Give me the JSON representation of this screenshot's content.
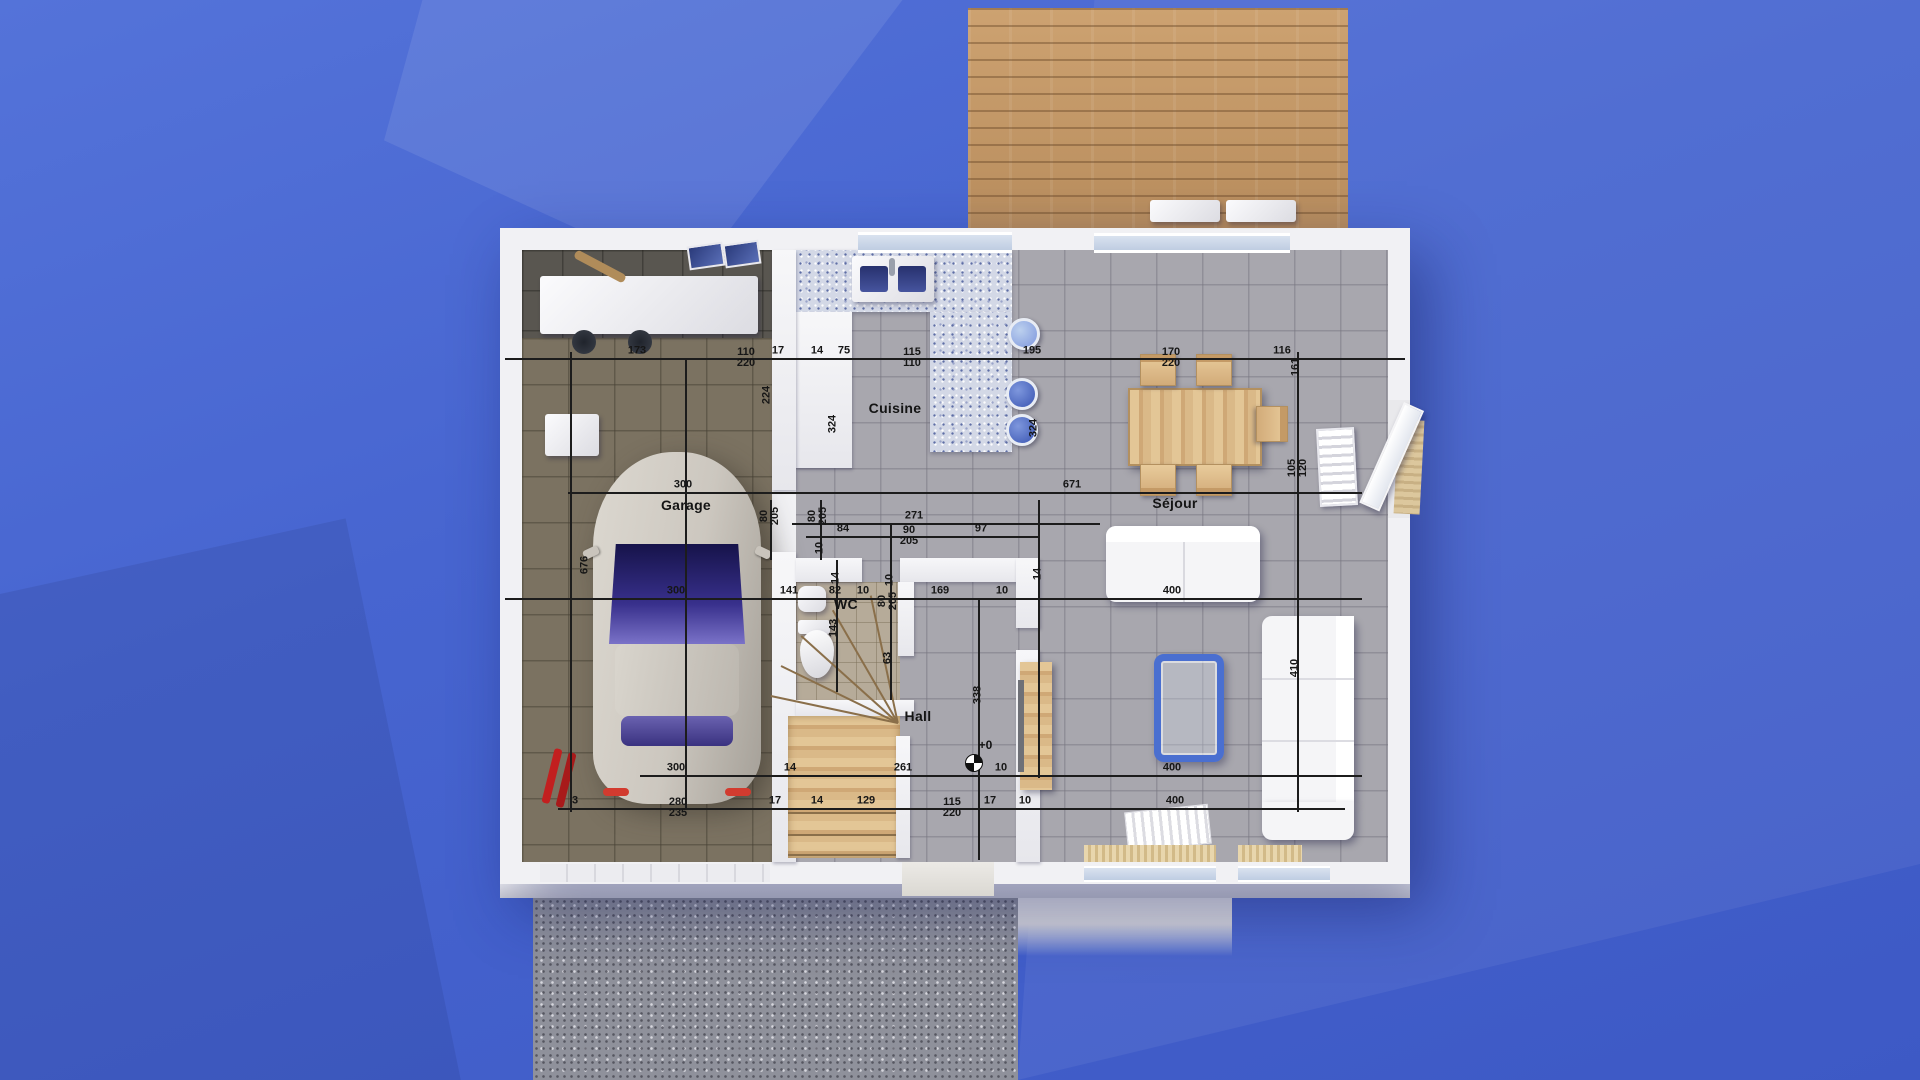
{
  "scene": {
    "description": "3D rendered ground-floor plan of a house on blue faceted background",
    "colors": {
      "background_blue": "#4765d0",
      "deck_wood": "#c59a6b",
      "gravel": "#8f919b",
      "wall_white": "#f1f1f4",
      "tile_floor": "#a8a7ae",
      "garage_floor": "#7b7261",
      "wc_floor": "#b6ab99",
      "counter_terrazzo": "#d3d8e6",
      "coffee_table_blue": "#4a6fd0",
      "dim_line": "#1c1c1c",
      "car_body": "#ccc7bf",
      "windshield": "#38308c"
    }
  },
  "rooms": [
    {
      "id": "garage",
      "label": "Garage",
      "x": 686,
      "y": 505
    },
    {
      "id": "cuisine",
      "label": "Cuisine",
      "x": 895,
      "y": 408
    },
    {
      "id": "wc",
      "label": "WC",
      "x": 846,
      "y": 604
    },
    {
      "id": "hall",
      "label": "Hall",
      "x": 918,
      "y": 716
    },
    {
      "id": "sejour",
      "label": "Séjour",
      "x": 1175,
      "y": 503
    }
  ],
  "level_marker": {
    "label": "+0",
    "x": 974,
    "y": 763
  },
  "dimensions": {
    "labels_horizontal": [
      {
        "x": 637,
        "y": 358,
        "t": "173"
      },
      {
        "x": 746,
        "y": 358,
        "t": "110",
        "b": "220"
      },
      {
        "x": 778,
        "y": 358,
        "t": "17"
      },
      {
        "x": 817,
        "y": 358,
        "t": "14"
      },
      {
        "x": 844,
        "y": 358,
        "t": "75"
      },
      {
        "x": 912,
        "y": 358,
        "t": "115",
        "b": "110"
      },
      {
        "x": 1032,
        "y": 358,
        "t": "195"
      },
      {
        "x": 1171,
        "y": 358,
        "t": "170",
        "b": "220"
      },
      {
        "x": 1282,
        "y": 358,
        "t": "116"
      },
      {
        "x": 683,
        "y": 492,
        "t": "300"
      },
      {
        "x": 1072,
        "y": 492,
        "t": "671"
      },
      {
        "x": 914,
        "y": 523,
        "t": "271"
      },
      {
        "x": 843,
        "y": 536,
        "t": "84"
      },
      {
        "x": 909,
        "y": 536,
        "t": "90",
        "b": "205"
      },
      {
        "x": 981,
        "y": 536,
        "t": "97"
      },
      {
        "x": 676,
        "y": 598,
        "t": "300"
      },
      {
        "x": 789,
        "y": 598,
        "t": "141"
      },
      {
        "x": 835,
        "y": 598,
        "t": "82"
      },
      {
        "x": 863,
        "y": 598,
        "t": "10"
      },
      {
        "x": 940,
        "y": 598,
        "t": "169"
      },
      {
        "x": 1002,
        "y": 598,
        "t": "10"
      },
      {
        "x": 1172,
        "y": 598,
        "t": "400"
      },
      {
        "x": 676,
        "y": 775,
        "t": "300"
      },
      {
        "x": 790,
        "y": 775,
        "t": "14"
      },
      {
        "x": 903,
        "y": 775,
        "t": "261"
      },
      {
        "x": 1001,
        "y": 775,
        "t": "10"
      },
      {
        "x": 1172,
        "y": 775,
        "t": "400"
      },
      {
        "x": 575,
        "y": 808,
        "t": "3"
      },
      {
        "x": 678,
        "y": 808,
        "t": "280",
        "b": "235"
      },
      {
        "x": 775,
        "y": 808,
        "t": "17"
      },
      {
        "x": 817,
        "y": 808,
        "t": "14"
      },
      {
        "x": 866,
        "y": 808,
        "t": "129"
      },
      {
        "x": 952,
        "y": 808,
        "t": "115",
        "b": "220"
      },
      {
        "x": 990,
        "y": 808,
        "t": "17"
      },
      {
        "x": 1025,
        "y": 808,
        "t": "10"
      },
      {
        "x": 1175,
        "y": 808,
        "t": "400"
      }
    ],
    "labels_vertical": [
      {
        "x": 767,
        "y": 395,
        "t": "224"
      },
      {
        "x": 833,
        "y": 424,
        "t": "324"
      },
      {
        "x": 1034,
        "y": 428,
        "t": "324"
      },
      {
        "x": 1296,
        "y": 367,
        "t": "161"
      },
      {
        "x": 1298,
        "y": 468,
        "t": "105",
        "b": "120"
      },
      {
        "x": 585,
        "y": 565,
        "t": "676"
      },
      {
        "x": 770,
        "y": 516,
        "t": "80",
        "b": "205"
      },
      {
        "x": 818,
        "y": 516,
        "t": "80",
        "b": "205"
      },
      {
        "x": 820,
        "y": 548,
        "t": "10"
      },
      {
        "x": 836,
        "y": 578,
        "t": "14"
      },
      {
        "x": 1038,
        "y": 574,
        "t": "14"
      },
      {
        "x": 890,
        "y": 580,
        "t": "10"
      },
      {
        "x": 834,
        "y": 628,
        "t": "143"
      },
      {
        "x": 888,
        "y": 601,
        "t": "80",
        "b": "205"
      },
      {
        "x": 888,
        "y": 658,
        "t": "63"
      },
      {
        "x": 978,
        "y": 695,
        "t": "338"
      },
      {
        "x": 1295,
        "y": 668,
        "t": "410"
      }
    ],
    "lines": {
      "h": [
        {
          "y": 358,
          "x1": 505,
          "x2": 1405
        },
        {
          "y": 492,
          "x1": 568,
          "x2": 1362
        },
        {
          "y": 523,
          "x1": 792,
          "x2": 1100
        },
        {
          "y": 536,
          "x1": 806,
          "x2": 1040
        },
        {
          "y": 598,
          "x1": 505,
          "x2": 1362
        },
        {
          "y": 775,
          "x1": 640,
          "x2": 1362
        },
        {
          "y": 808,
          "x1": 558,
          "x2": 1345
        }
      ],
      "v": [
        {
          "x": 570,
          "y1": 352,
          "y2": 812
        },
        {
          "x": 685,
          "y1": 358,
          "y2": 808
        },
        {
          "x": 770,
          "y1": 500,
          "y2": 560
        },
        {
          "x": 820,
          "y1": 500,
          "y2": 560
        },
        {
          "x": 836,
          "y1": 560,
          "y2": 692
        },
        {
          "x": 890,
          "y1": 523,
          "y2": 700
        },
        {
          "x": 978,
          "y1": 598,
          "y2": 860
        },
        {
          "x": 1038,
          "y1": 500,
          "y2": 778
        },
        {
          "x": 1297,
          "y1": 352,
          "y2": 812
        }
      ]
    }
  }
}
